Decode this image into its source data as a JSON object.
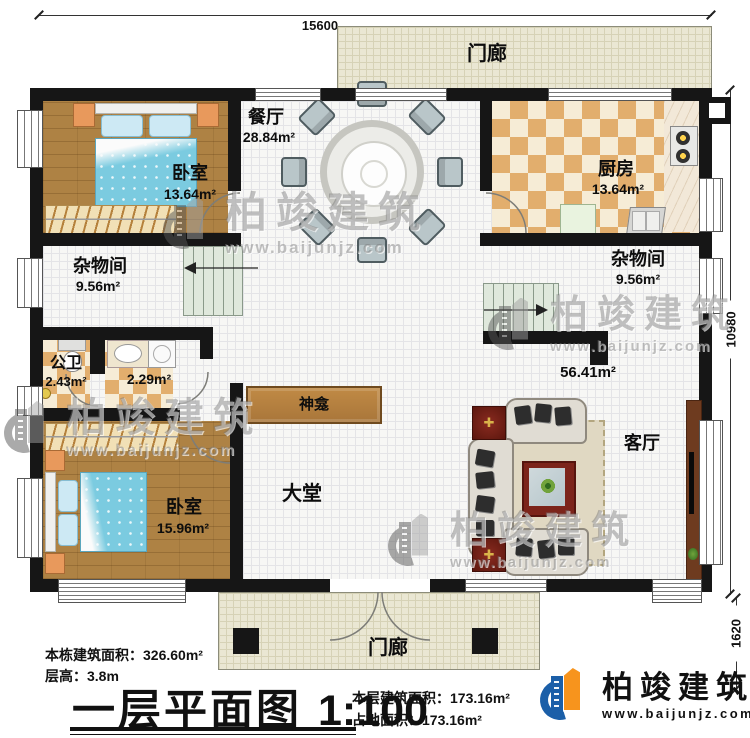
{
  "plan": {
    "dimensions": {
      "top": "15600",
      "right": "10980",
      "bottom_right": "1620"
    },
    "rooms": {
      "bedroom1": {
        "name": "卧室",
        "area": "13.64m²"
      },
      "dining": {
        "name": "餐厅",
        "area": "28.84m²"
      },
      "kitchen": {
        "name": "厨房",
        "area": "13.64m²"
      },
      "storage_left": {
        "name": "杂物间",
        "area": "9.56m²"
      },
      "storage_right": {
        "name": "杂物间",
        "area": "9.56m²"
      },
      "bathroom": {
        "name": "公卫",
        "area": "2.43m²"
      },
      "washroom": {
        "area": "2.29m²"
      },
      "shrine": {
        "name": "神龛"
      },
      "bedroom2": {
        "name": "卧室",
        "area": "15.96m²"
      },
      "hall": {
        "name": "大堂"
      },
      "living": {
        "name": "客厅",
        "area": "56.41m²"
      },
      "porch_top": {
        "name": "门廊"
      },
      "porch_bottom": {
        "name": "门廊"
      }
    }
  },
  "title_block": {
    "building_area_label": "本栋建筑面积：",
    "building_area_value": "326.60m²",
    "floor_height_label": "层高：",
    "floor_height_value": "3.8m",
    "plan_name": "一层平面图",
    "scale": "1:100",
    "floor_area_label": "本层建筑面积：",
    "floor_area_value": "173.16m²",
    "footprint_label": "占地面积：",
    "footprint_value": "173.16m²"
  },
  "brand": {
    "name": "柏竣建筑",
    "url": "www.baijunjz.com"
  },
  "watermark": {
    "name": "柏竣建筑",
    "url": "www.baijunjz.com"
  },
  "colors": {
    "wall": "#161616",
    "wood": "#ae8244",
    "checker": "#e2ae6d",
    "porch": "#eae7d3",
    "stairs": "#dfe8dc",
    "brand_blue": "#1b5fa8",
    "brand_orange": "#f7941d"
  }
}
